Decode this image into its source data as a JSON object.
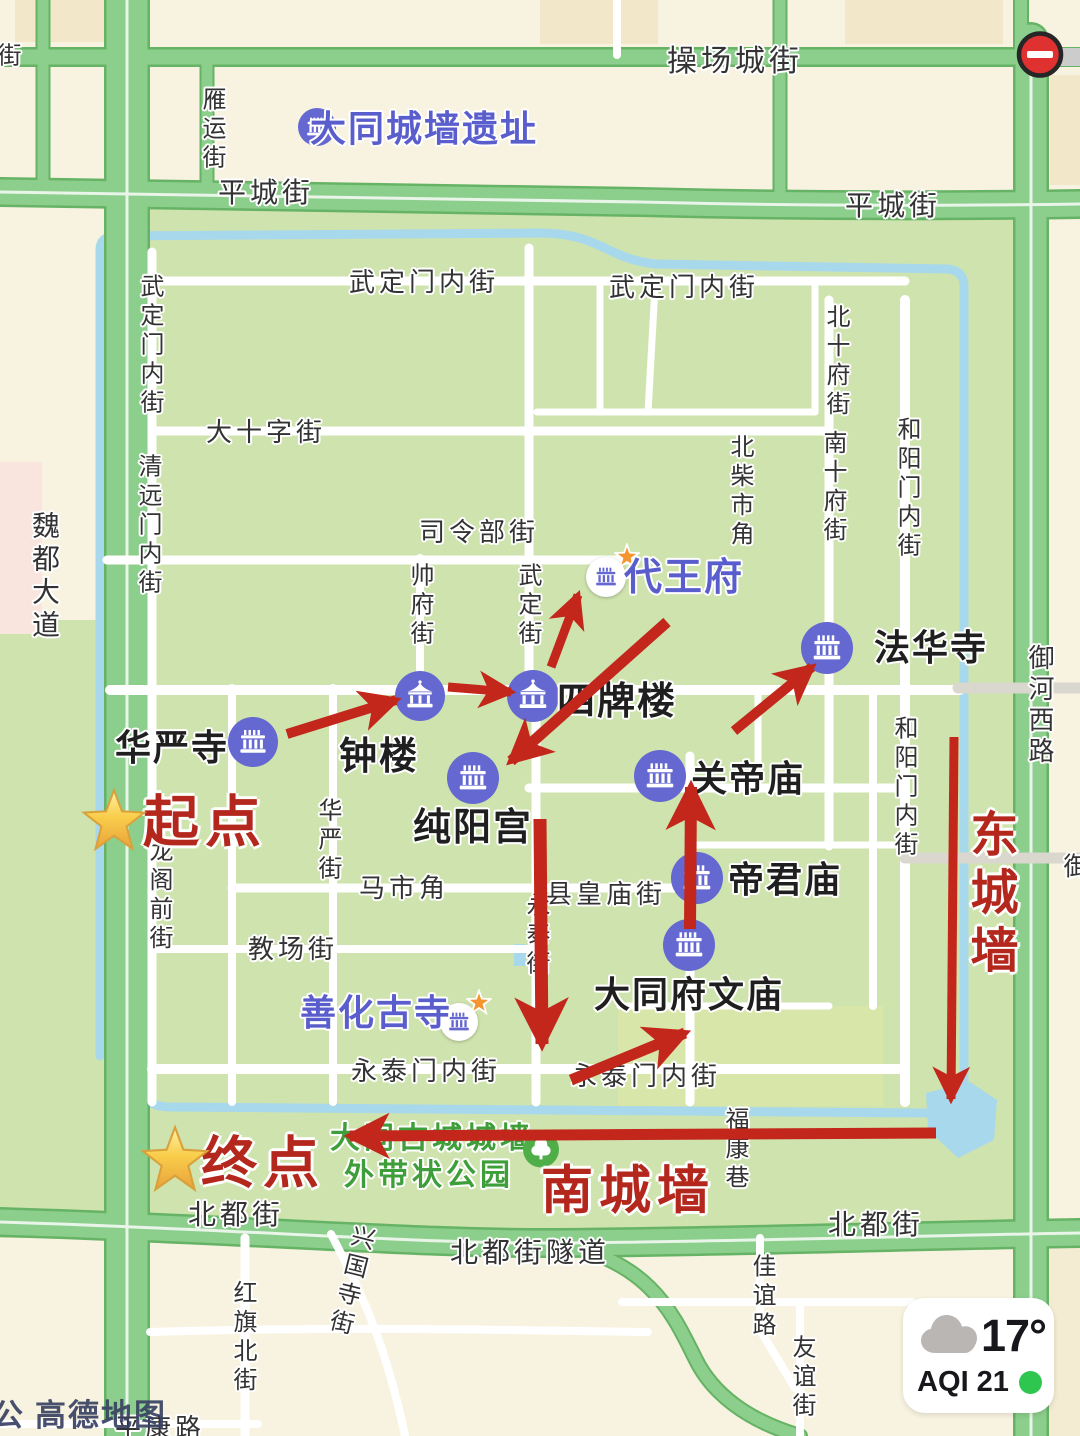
{
  "app": {
    "watermark_primary": "高德地图",
    "watermark_edge": "公"
  },
  "weather": {
    "temperature": "17°",
    "aqi": "AQI 21"
  },
  "traffic_event": {
    "type": "no-entry"
  },
  "legend_colors": {
    "route_red": "#C3271B",
    "annotation_red": "#B4271D",
    "poi_circle_purple": "#6468D0",
    "poi_text_purple": "#5A5ECC",
    "park_text_green": "#3E9E39",
    "road_green": "#8CCE8C",
    "water_blue": "#A8D8EB",
    "city_green": "#CFE3AE",
    "outside_cream": "#F8F3E1"
  },
  "map": {
    "streets": [
      {
        "t": "操场城街",
        "x": 735,
        "y": 62,
        "d": "h",
        "s": 30
      },
      {
        "t": "平城街",
        "x": 266,
        "y": 193,
        "d": "h",
        "s": 28
      },
      {
        "t": "平城街",
        "x": 893,
        "y": 206,
        "d": "h",
        "s": 28
      },
      {
        "t": "雁运街",
        "x": 211,
        "y": 130,
        "d": "v",
        "s": 24
      },
      {
        "t": "街",
        "x": 6,
        "y": 57,
        "d": "v",
        "s": 24
      },
      {
        "t": "魏都大道",
        "x": 44,
        "y": 577,
        "d": "v",
        "s": 28
      },
      {
        "t": "武定门内街",
        "x": 424,
        "y": 282,
        "d": "h",
        "s": 26
      },
      {
        "t": "武定门内街",
        "x": 684,
        "y": 287,
        "d": "h",
        "s": 26
      },
      {
        "t": "武定门内街",
        "x": 149,
        "y": 346,
        "d": "v",
        "s": 24
      },
      {
        "t": "大十字街",
        "x": 266,
        "y": 432,
        "d": "h",
        "s": 26
      },
      {
        "t": "清远门内街",
        "x": 147,
        "y": 526,
        "d": "v",
        "s": 24
      },
      {
        "t": "司令部街",
        "x": 479,
        "y": 532,
        "d": "h",
        "s": 26
      },
      {
        "t": "帅府街",
        "x": 419,
        "y": 606,
        "d": "v",
        "s": 24
      },
      {
        "t": "武定街",
        "x": 527,
        "y": 606,
        "d": "v",
        "s": 24
      },
      {
        "t": "北柴市角",
        "x": 739,
        "y": 492,
        "d": "v",
        "s": 24
      },
      {
        "t": "北十府街",
        "x": 835,
        "y": 362,
        "d": "v",
        "s": 24
      },
      {
        "t": "南十府街",
        "x": 832,
        "y": 488,
        "d": "v",
        "s": 24
      },
      {
        "t": "和阳门内街",
        "x": 906,
        "y": 489,
        "d": "v",
        "s": 24
      },
      {
        "t": "和阳门内街",
        "x": 903,
        "y": 788,
        "d": "v",
        "s": 24
      },
      {
        "t": "御河西路",
        "x": 1040,
        "y": 706,
        "d": "v",
        "s": 26
      },
      {
        "t": "御",
        "x": 1075,
        "y": 868,
        "d": "v",
        "s": 26
      },
      {
        "t": "华严街",
        "x": 327,
        "y": 841,
        "d": "v",
        "s": 24
      },
      {
        "t": "龙阁前街",
        "x": 158,
        "y": 896,
        "d": "v",
        "s": 24
      },
      {
        "t": "马市角",
        "x": 404,
        "y": 888,
        "d": "h",
        "s": 26
      },
      {
        "t": "教场街",
        "x": 293,
        "y": 949,
        "d": "h",
        "s": 26
      },
      {
        "t": "县皇庙街",
        "x": 606,
        "y": 894,
        "d": "h",
        "s": 26
      },
      {
        "t": "永泰街",
        "x": 535,
        "y": 936,
        "d": "v",
        "s": 24
      },
      {
        "t": "永泰门内街",
        "x": 426,
        "y": 1071,
        "d": "h",
        "s": 26
      },
      {
        "t": "永泰门内街",
        "x": 646,
        "y": 1076,
        "d": "h",
        "s": 26
      },
      {
        "t": "福康巷",
        "x": 734,
        "y": 1150,
        "d": "v",
        "s": 24
      },
      {
        "t": "北都街",
        "x": 236,
        "y": 1215,
        "d": "h",
        "s": 28
      },
      {
        "t": "北都街",
        "x": 876,
        "y": 1225,
        "d": "h",
        "s": 28
      },
      {
        "t": "北都街隧道",
        "x": 530,
        "y": 1253,
        "d": "h",
        "s": 28
      },
      {
        "t": "兴国寺街",
        "x": 349,
        "y": 1281,
        "d": "v",
        "s": 24,
        "cls": "tilt"
      },
      {
        "t": "红旗北街",
        "x": 242,
        "y": 1338,
        "d": "v",
        "s": 24
      },
      {
        "t": "佳谊路",
        "x": 761,
        "y": 1297,
        "d": "v",
        "s": 24
      },
      {
        "t": "友谊街",
        "x": 801,
        "y": 1378,
        "d": "v",
        "s": 24
      },
      {
        "t": "平康路",
        "x": 160,
        "y": 1428,
        "d": "h",
        "s": 26
      }
    ],
    "park_labels": [
      {
        "t": "大同古城城墙",
        "x": 432,
        "y": 1139,
        "s": 30
      },
      {
        "t": "外带状公园",
        "x": 429,
        "y": 1176,
        "s": 30
      }
    ],
    "park_tree_icon": {
      "x": 541,
      "y": 1152,
      "r": 18
    },
    "pois": [
      {
        "name": "大同城墙遗址",
        "cx": 317,
        "cy": 127,
        "r": 19,
        "icon": "hall",
        "variant": "purple",
        "label": {
          "t": "大同城墙遗址",
          "x": 424,
          "y": 129,
          "s": 36,
          "c": "purple"
        }
      },
      {
        "name": "华严寺",
        "cx": 253,
        "cy": 742,
        "r": 25,
        "icon": "hall",
        "variant": "purple",
        "label": {
          "t": "华严寺",
          "x": 172,
          "y": 748,
          "s": 36,
          "c": "dark"
        }
      },
      {
        "name": "钟楼",
        "cx": 420,
        "cy": 696,
        "r": 25,
        "icon": "pavilion",
        "variant": "purple",
        "label": {
          "t": "钟楼",
          "x": 379,
          "y": 757,
          "s": 38,
          "c": "dark"
        }
      },
      {
        "name": "四牌楼",
        "cx": 533,
        "cy": 696,
        "r": 26,
        "icon": "pavilion",
        "variant": "purple",
        "label": {
          "t": "四牌楼",
          "x": 617,
          "y": 702,
          "s": 38,
          "c": "dark"
        }
      },
      {
        "name": "纯阳宫",
        "cx": 473,
        "cy": 778,
        "r": 26,
        "icon": "hall",
        "variant": "purple",
        "label": {
          "t": "纯阳宫",
          "x": 473,
          "y": 828,
          "s": 38,
          "c": "dark"
        }
      },
      {
        "name": "代王府",
        "cx": 606,
        "cy": 577,
        "r": 20,
        "icon": "hall",
        "variant": "landmark",
        "label": {
          "t": "代王府",
          "x": 684,
          "y": 578,
          "s": 38,
          "c": "purple"
        }
      },
      {
        "name": "法华寺",
        "cx": 827,
        "cy": 648,
        "r": 26,
        "icon": "hall",
        "variant": "purple",
        "label": {
          "t": "法华寺",
          "x": 931,
          "y": 648,
          "s": 36,
          "c": "dark"
        }
      },
      {
        "name": "关帝庙",
        "cx": 660,
        "cy": 776,
        "r": 26,
        "icon": "hall",
        "variant": "purple",
        "label": {
          "t": "关帝庙",
          "x": 748,
          "y": 779,
          "s": 36,
          "c": "dark"
        }
      },
      {
        "name": "帝君庙",
        "cx": 697,
        "cy": 878,
        "r": 26,
        "icon": "hall",
        "variant": "purple",
        "label": {
          "t": "帝君庙",
          "x": 785,
          "y": 880,
          "s": 36,
          "c": "dark"
        }
      },
      {
        "name": "大同府文庙",
        "cx": 689,
        "cy": 945,
        "r": 26,
        "icon": "hall",
        "variant": "purple",
        "label": {
          "t": "大同府文庙",
          "x": 689,
          "y": 995,
          "s": 36,
          "c": "dark"
        }
      },
      {
        "name": "善化古寺",
        "cx": 459,
        "cy": 1022,
        "r": 19,
        "icon": "hall",
        "variant": "landmark",
        "label": {
          "t": "善化古寺",
          "x": 376,
          "y": 1013,
          "s": 36,
          "c": "purple"
        }
      }
    ],
    "route": {
      "arrows": [
        {
          "x1": 287,
          "y1": 734,
          "x2": 396,
          "y2": 700,
          "w": 10
        },
        {
          "x1": 448,
          "y1": 687,
          "x2": 511,
          "y2": 692,
          "w": 9
        },
        {
          "x1": 551,
          "y1": 667,
          "x2": 578,
          "y2": 595,
          "w": 9
        },
        {
          "x1": 667,
          "y1": 622,
          "x2": 511,
          "y2": 761,
          "w": 11
        },
        {
          "x1": 734,
          "y1": 731,
          "x2": 812,
          "y2": 667,
          "w": 10
        },
        {
          "x1": 690,
          "y1": 929,
          "x2": 691,
          "y2": 787,
          "w": 12
        },
        {
          "x1": 540,
          "y1": 819,
          "x2": 542,
          "y2": 1044,
          "w": 13
        },
        {
          "x1": 571,
          "y1": 1080,
          "x2": 685,
          "y2": 1033,
          "w": 11
        },
        {
          "x1": 936,
          "y1": 1133,
          "x2": 350,
          "y2": 1136,
          "w": 11
        },
        {
          "x1": 954,
          "y1": 737,
          "x2": 951,
          "y2": 1099,
          "w": 9
        }
      ],
      "wall_labels": [
        {
          "t": "东城墙",
          "x": 988,
          "y": 896,
          "d": "v",
          "s": 48
        },
        {
          "t": "南城墙",
          "x": 628,
          "y": 1192,
          "d": "h",
          "s": 52
        }
      ],
      "endpoints": [
        {
          "t": "起点",
          "x": 205,
          "y": 822,
          "s": 56,
          "star": {
            "x": 114,
            "y": 823,
            "size": 66
          }
        },
        {
          "t": "终点",
          "x": 263,
          "y": 1163,
          "s": 56,
          "star": {
            "x": 175,
            "y": 1162,
            "size": 70
          }
        }
      ]
    }
  }
}
